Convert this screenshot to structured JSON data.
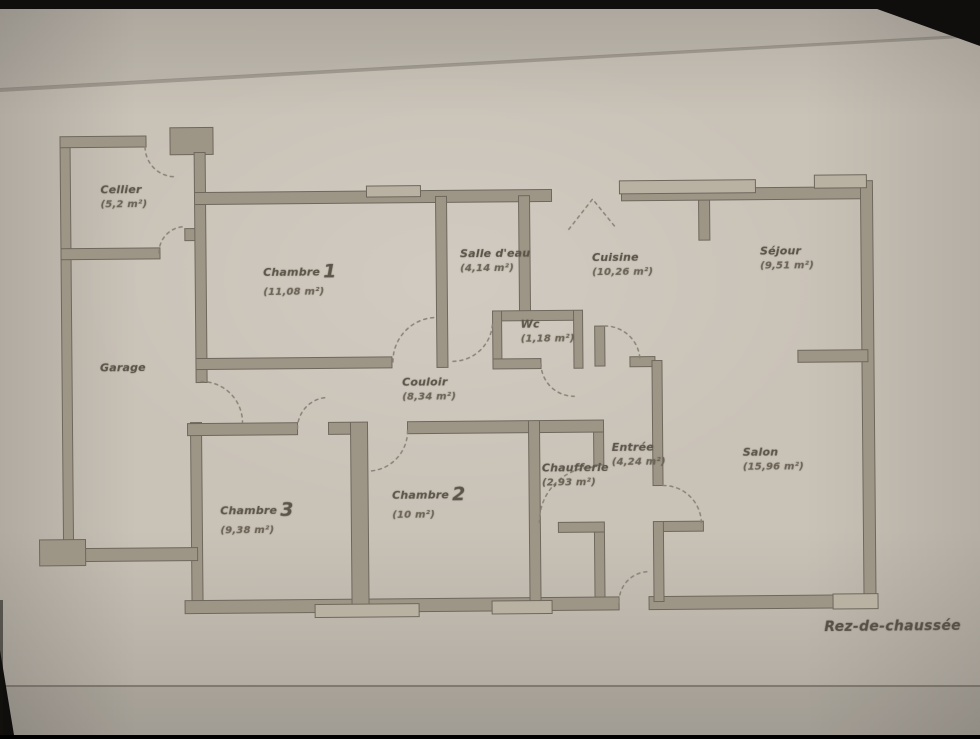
{
  "floor_label": "Rez-de-chaussée",
  "rooms": [
    {
      "id": "cellier",
      "name": "Cellier",
      "area": "(5,2 m²)"
    },
    {
      "id": "garage",
      "name": "Garage",
      "area": ""
    },
    {
      "id": "chambre-1",
      "name": "Chambre",
      "number": "1",
      "area": "(11,08 m²)"
    },
    {
      "id": "salle-d-eau",
      "name": "Salle d'eau",
      "area": "(4,14 m²)"
    },
    {
      "id": "cuisine",
      "name": "Cuisine",
      "area": "(10,26 m²)"
    },
    {
      "id": "sejour",
      "name": "Séjour",
      "area": "(9,51 m²)"
    },
    {
      "id": "wc",
      "name": "Wc",
      "area": "(1,18 m²)"
    },
    {
      "id": "couloir",
      "name": "Couloir",
      "area": "(8,34 m²)"
    },
    {
      "id": "entree",
      "name": "Entrée",
      "area": "(4,24 m²)"
    },
    {
      "id": "chaufferie",
      "name": "Chaufferie",
      "area": "(2,93 m²)"
    },
    {
      "id": "salon",
      "name": "Salon",
      "area": "(15,96 m²)"
    },
    {
      "id": "chambre-3",
      "name": "Chambre",
      "number": "3",
      "area": "(9,38 m²)"
    },
    {
      "id": "chambre-2",
      "name": "Chambre",
      "number": "2",
      "area": "(10 m²)"
    }
  ],
  "colors": {
    "paper": "#c9c2b7",
    "wall": "#9d9586",
    "wallstroke": "#6e675c",
    "windowfill": "#b9b1a2",
    "doordash": "#8a8276",
    "ink": "#5c5549",
    "inklight": "#6b6456",
    "edge": "#100e0c"
  }
}
